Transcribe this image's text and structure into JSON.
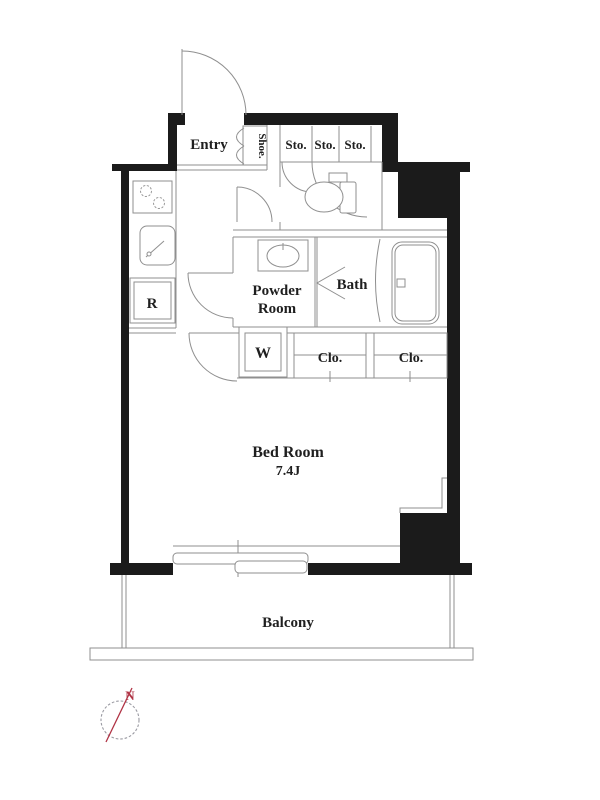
{
  "floorplan": {
    "rooms": {
      "entry": "Entry",
      "shoe_cabinet": "Shoe.",
      "storage": "Sto.",
      "powder_room_line1": "Powder",
      "powder_room_line2": "Room",
      "bath": "Bath",
      "washer": "W",
      "refrigerator": "R",
      "closet": "Clo.",
      "bedroom": "Bed Room",
      "bedroom_size": "7.4J",
      "balcony": "Balcony"
    },
    "compass": {
      "north": "N"
    },
    "colors": {
      "wall": "#1b1b1b",
      "thin_line": "#8f8f8f",
      "label_text": "#1f1f1f",
      "compass_red": "#b03345",
      "background": "#ffffff"
    }
  }
}
